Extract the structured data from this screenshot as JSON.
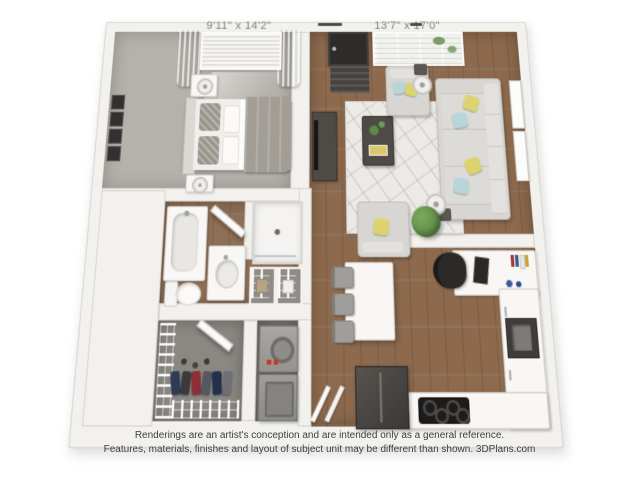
{
  "dimension_labels": {
    "bedroom": "9'11\" x 14'2\"",
    "living_room": "13'7\" x 17'0\""
  },
  "footer": {
    "line1": "Renderings are an artist's conception and are intended only as a general reference.",
    "line2": "Features, materials, finishes and layout of subject unit may be different than shown. 3DPlans.com"
  },
  "colors": {
    "wood": "#8d6a4e",
    "carpet": "#b5b1ab",
    "closetFloor": "#8b8883",
    "wall": "#f2f1ee",
    "wallEdge": "#d9d6d2",
    "rug": "#eceae7",
    "accentYellow": "#ddd36e",
    "accentBlue": "#b8d6da",
    "plantGreen": "#5c8a46",
    "darkFurniture": "#4e4a45",
    "applianceDark": "#3f3d3b",
    "labelText": "#807e7b",
    "footerText": "#3e3e3e"
  }
}
